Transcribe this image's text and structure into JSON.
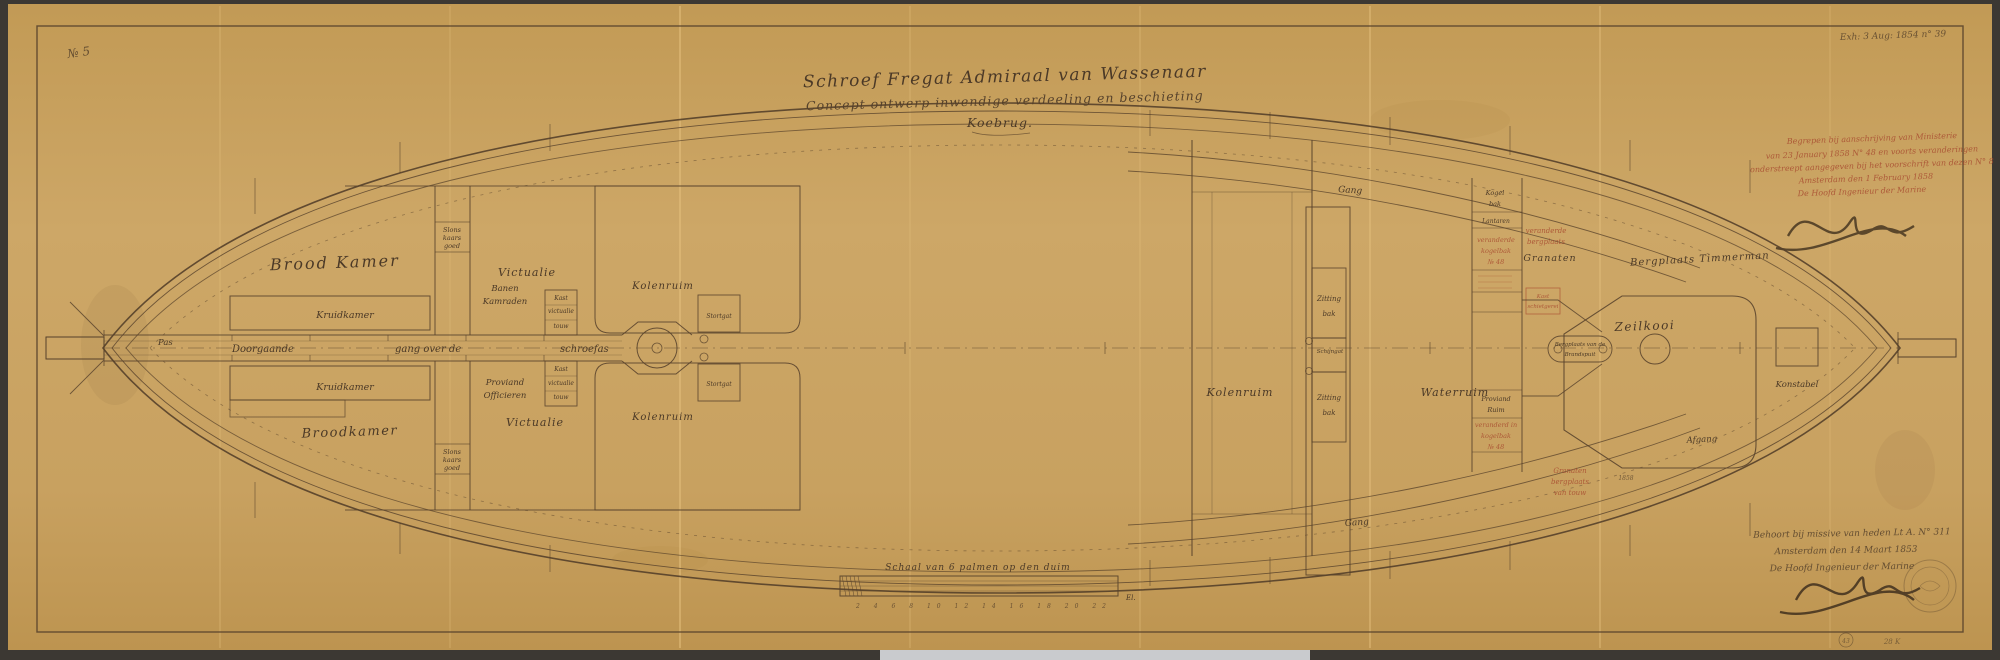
{
  "sheet": {
    "number": "№ 5",
    "archive_note": "Exh: 3 Aug: 1854 n° 39",
    "corner_stamp": "43",
    "corner_mark": "28 K"
  },
  "title": {
    "line1": "Schroef Fregat Admiraal van Wassenaar",
    "line2": "Concept ontwerp inwendige verdeeling en beschieting",
    "line3": "Koebrug."
  },
  "red_annotation": {
    "l1": "Begrepen bij aanschrijving van Ministerie",
    "l2": "van 23 January 1858 N° 48 en voorts veranderingen",
    "l3": "onderstreept aangegeven bij het voorschrift van dezen N° 8",
    "l4": "Amsterdam den 1 February 1858",
    "l5": "De Hoofd Ingenieur der Marine"
  },
  "approval": {
    "l1": "Behoort bij missive van heden Lt A. N° 311",
    "l2": "Amsterdam den 14 Maart 1853",
    "l3": "De Hoofd Ingenieur der Marine"
  },
  "scale_bar": {
    "label": "Schaal van 6 palmen op den duim",
    "numbers": "2 4 6 8 10 12 14 16 18 20 22",
    "end_label": "El."
  },
  "rooms": {
    "corridor": {
      "l1": "Doorgaande",
      "l2": "gang over de",
      "l3": "schroefas"
    },
    "pas": "Pas",
    "brood_kamer": "Brood Kamer",
    "kruidkamer": "Kruidkamer",
    "broodkamer_onder": "Broodkamer",
    "klein_magazijn": {
      "l1": "Slons",
      "l2": "kaars",
      "l3": "goed"
    },
    "banen": {
      "l1": "Banen",
      "l2": "Kamraden"
    },
    "proviand_officieren": {
      "l1": "Proviand",
      "l2": "Officieren"
    },
    "victualie": "Victualie",
    "kast": {
      "l1": "Kast",
      "l2": "victualie",
      "l3": "touw"
    },
    "kolenruim_achter": "Kolenruim",
    "stortgat": "Stortgat",
    "kolenruim": "Kolenruim",
    "waterruim": "Waterruim",
    "zittingbak": {
      "l1": "Zitting",
      "l2": "bak"
    },
    "schijngat": "Schijngat",
    "gang": "Gang",
    "kogelbak": {
      "l1": "Kogel",
      "l2": "bak"
    },
    "lantaren": "Lantaren",
    "granaten": "Granaten",
    "zeilkooi": "Zeilkooi",
    "bergplaats_timmerman": "Bergplaats Timmerman",
    "brandspuit": {
      "l1": "Bergplaats van de",
      "l2": "Brandspuit"
    },
    "afgang": "Afgang",
    "konstabel": "Konstabel",
    "proviand_ruim": {
      "l1": "Proviand",
      "l2": "Ruim"
    },
    "jaartal": "1858"
  },
  "red_notes": {
    "boven": {
      "l1": "veranderde",
      "l2": "kogelbak",
      "l3": "№ 48"
    },
    "granaten": {
      "l1": "veranderde",
      "l2": "bergplaats"
    },
    "kast": {
      "l1": "Kast",
      "l2": "schietgerei"
    },
    "onder": {
      "l1": "veranderd in",
      "l2": "kogelbak",
      "l3": "№ 48"
    },
    "bergplaats": {
      "l1": "Granaten",
      "l2": "bergplaats",
      "l3": "van touw"
    }
  },
  "colors": {
    "paper": "#c8a25f",
    "ink": "#4b3927",
    "red_ink": "#a6472e"
  }
}
